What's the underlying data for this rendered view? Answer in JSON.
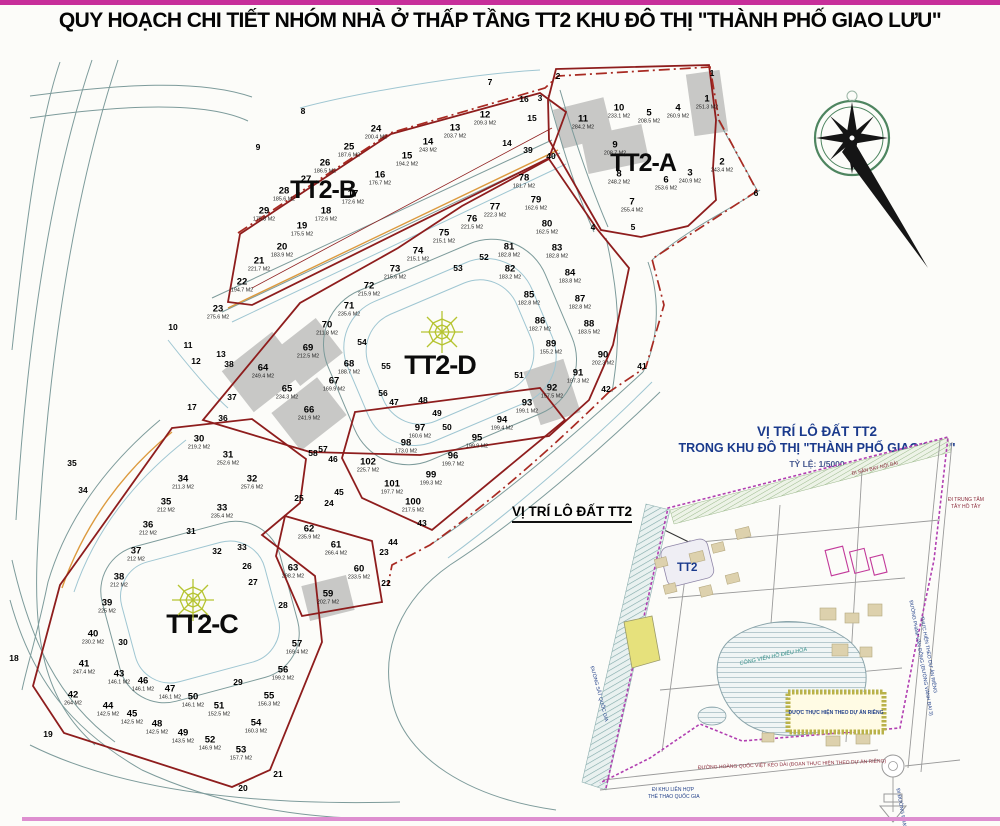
{
  "page": {
    "title": "QUY HOẠCH CHI TIẾT NHÓM NHÀ Ở THẤP TẦNG TT2 KHU ĐÔ THỊ \"THÀNH PHỐ GIAO LƯU\""
  },
  "map": {
    "blocks": [
      {
        "id": "tt2-a",
        "label": "TT2-A"
      },
      {
        "id": "tt2-b",
        "label": "TT2-B"
      },
      {
        "id": "tt2-c",
        "label": "TT2-C"
      },
      {
        "id": "tt2-d",
        "label": "TT2-D"
      }
    ],
    "parcels": [
      {
        "n": "1",
        "a": "251.3 M2",
        "x": 707,
        "y": 103,
        "g": 1,
        "r": -8,
        "w": 34,
        "h": 62
      },
      {
        "n": "2",
        "a": "243.4 M2",
        "x": 722,
        "y": 166
      },
      {
        "n": "3",
        "a": "240.9 M2",
        "x": 690,
        "y": 177
      },
      {
        "n": "4",
        "a": "260.9 M2",
        "x": 678,
        "y": 112
      },
      {
        "n": "5",
        "a": "208.5 M2",
        "x": 649,
        "y": 117
      },
      {
        "n": "6",
        "a": "253.6 M2",
        "x": 666,
        "y": 184
      },
      {
        "n": "7",
        "a": "255.4 M2",
        "x": 632,
        "y": 206
      },
      {
        "n": "8",
        "a": "248.2 M2",
        "x": 619,
        "y": 178
      },
      {
        "n": "9",
        "a": "208.7 M2",
        "x": 615,
        "y": 149,
        "g": 1,
        "r": -12,
        "w": 62,
        "h": 38
      },
      {
        "n": "10",
        "a": "233.1 M2",
        "x": 619,
        "y": 112
      },
      {
        "n": "11",
        "a": "284.2 M2",
        "x": 583,
        "y": 123,
        "g": 1,
        "r": -14,
        "w": 52,
        "h": 40
      },
      {
        "n": "12",
        "a": "209.3 M2",
        "x": 485,
        "y": 119
      },
      {
        "n": "13",
        "a": "203.7 M2",
        "x": 455,
        "y": 132
      },
      {
        "n": "14",
        "a": "243 M2",
        "x": 428,
        "y": 146
      },
      {
        "n": "15",
        "a": "194.2 M2",
        "x": 407,
        "y": 160
      },
      {
        "n": "16",
        "a": "176.7 M2",
        "x": 380,
        "y": 179
      },
      {
        "n": "17",
        "a": "172.6 M2",
        "x": 353,
        "y": 198
      },
      {
        "n": "18",
        "a": "172.6 M2",
        "x": 326,
        "y": 215
      },
      {
        "n": "19",
        "a": "175.5 M2",
        "x": 302,
        "y": 230
      },
      {
        "n": "20",
        "a": "183.9 M2",
        "x": 282,
        "y": 251
      },
      {
        "n": "21",
        "a": "221.7 M2",
        "x": 259,
        "y": 265
      },
      {
        "n": "22",
        "a": "194.7 M2",
        "x": 242,
        "y": 286
      },
      {
        "n": "23",
        "a": "275.6 M2",
        "x": 218,
        "y": 313
      },
      {
        "n": "24",
        "a": "200.4 M2",
        "x": 376,
        "y": 133
      },
      {
        "n": "25",
        "a": "187.6 M2",
        "x": 349,
        "y": 151
      },
      {
        "n": "26",
        "a": "186.5 M2",
        "x": 325,
        "y": 167
      },
      {
        "n": "27",
        "a": "",
        "x": 306,
        "y": 180
      },
      {
        "n": "28",
        "a": "185.6 M2",
        "x": 284,
        "y": 195
      },
      {
        "n": "29",
        "a": "175.8 M2",
        "x": 264,
        "y": 215
      },
      {
        "n": "30",
        "a": "219.2 M2",
        "x": 199,
        "y": 443
      },
      {
        "n": "31",
        "a": "252.6 M2",
        "x": 228,
        "y": 459
      },
      {
        "n": "32",
        "a": "257.6 M2",
        "x": 252,
        "y": 483
      },
      {
        "n": "33",
        "a": "235.4 M2",
        "x": 222,
        "y": 512
      },
      {
        "n": "34",
        "a": "211.3 M2",
        "x": 183,
        "y": 483
      },
      {
        "n": "35",
        "a": "212 M2",
        "x": 166,
        "y": 506
      },
      {
        "n": "36",
        "a": "212 M2",
        "x": 148,
        "y": 529
      },
      {
        "n": "37",
        "a": "212 M2",
        "x": 136,
        "y": 555
      },
      {
        "n": "38",
        "a": "212 M2",
        "x": 119,
        "y": 581
      },
      {
        "n": "39",
        "a": "225 M2",
        "x": 107,
        "y": 607
      },
      {
        "n": "40",
        "a": "230.2 M2",
        "x": 93,
        "y": 638
      },
      {
        "n": "41",
        "a": "247.4 M2",
        "x": 84,
        "y": 668
      },
      {
        "n": "42",
        "a": "264 M2",
        "x": 73,
        "y": 699
      },
      {
        "n": "43",
        "a": "146.1 M2",
        "x": 119,
        "y": 678
      },
      {
        "n": "44",
        "a": "142.5 M2",
        "x": 108,
        "y": 710
      },
      {
        "n": "45",
        "a": "142.5 M2",
        "x": 132,
        "y": 718
      },
      {
        "n": "46",
        "a": "146.1 M2",
        "x": 143,
        "y": 685
      },
      {
        "n": "47",
        "a": "146.1 M2",
        "x": 170,
        "y": 693
      },
      {
        "n": "48",
        "a": "142.5 M2",
        "x": 157,
        "y": 728
      },
      {
        "n": "49",
        "a": "143.5 M2",
        "x": 183,
        "y": 737
      },
      {
        "n": "50",
        "a": "146.1 M2",
        "x": 193,
        "y": 701
      },
      {
        "n": "51",
        "a": "152.5 M2",
        "x": 219,
        "y": 710
      },
      {
        "n": "52",
        "a": "146.9 M2",
        "x": 210,
        "y": 744
      },
      {
        "n": "53",
        "a": "157.7 M2",
        "x": 241,
        "y": 754
      },
      {
        "n": "54",
        "a": "160.3 M2",
        "x": 256,
        "y": 727
      },
      {
        "n": "55",
        "a": "156.3 M2",
        "x": 269,
        "y": 700
      },
      {
        "n": "56",
        "a": "199.2 M2",
        "x": 283,
        "y": 674
      },
      {
        "n": "57",
        "a": "169.4 M2",
        "x": 297,
        "y": 648
      },
      {
        "n": "59",
        "a": "202.7 M2",
        "x": 328,
        "y": 598,
        "g": 1,
        "r": -14,
        "w": 46,
        "h": 36
      },
      {
        "n": "60",
        "a": "233.5 M2",
        "x": 359,
        "y": 573
      },
      {
        "n": "61",
        "a": "266.4 M2",
        "x": 336,
        "y": 549
      },
      {
        "n": "62",
        "a": "235.9 M2",
        "x": 309,
        "y": 533
      },
      {
        "n": "63",
        "a": "298.2 M2",
        "x": 293,
        "y": 572
      },
      {
        "n": "64",
        "a": "249.4 M2",
        "x": 263,
        "y": 372,
        "g": 1,
        "r": -38,
        "w": 64,
        "h": 52
      },
      {
        "n": "65",
        "a": "234.3 M2",
        "x": 287,
        "y": 393
      },
      {
        "n": "66",
        "a": "241.9 M2",
        "x": 309,
        "y": 414,
        "g": 1,
        "r": -38,
        "w": 58,
        "h": 48
      },
      {
        "n": "67",
        "a": "169.9 M2",
        "x": 334,
        "y": 385
      },
      {
        "n": "68",
        "a": "188.7 M2",
        "x": 349,
        "y": 368
      },
      {
        "n": "69",
        "a": "212.5 M2",
        "x": 308,
        "y": 352,
        "g": 1,
        "r": -38,
        "w": 54,
        "h": 44
      },
      {
        "n": "70",
        "a": "211.8 M2",
        "x": 327,
        "y": 329
      },
      {
        "n": "71",
        "a": "235.6 M2",
        "x": 349,
        "y": 310
      },
      {
        "n": "72",
        "a": "215.9 M2",
        "x": 369,
        "y": 290
      },
      {
        "n": "73",
        "a": "215.6 M2",
        "x": 395,
        "y": 273
      },
      {
        "n": "74",
        "a": "215.1 M2",
        "x": 418,
        "y": 255
      },
      {
        "n": "75",
        "a": "215.1 M2",
        "x": 444,
        "y": 237
      },
      {
        "n": "76",
        "a": "221.5 M2",
        "x": 472,
        "y": 223
      },
      {
        "n": "77",
        "a": "222.3 M2",
        "x": 495,
        "y": 211
      },
      {
        "n": "78",
        "a": "181.7 M2",
        "x": 524,
        "y": 182
      },
      {
        "n": "79",
        "a": "162.6 M2",
        "x": 536,
        "y": 204
      },
      {
        "n": "80",
        "a": "162.5 M2",
        "x": 547,
        "y": 228
      },
      {
        "n": "81",
        "a": "182.8 M2",
        "x": 509,
        "y": 251
      },
      {
        "n": "82",
        "a": "183.2 M2",
        "x": 510,
        "y": 273
      },
      {
        "n": "83",
        "a": "182.8 M2",
        "x": 557,
        "y": 252
      },
      {
        "n": "84",
        "a": "183.8 M2",
        "x": 570,
        "y": 277
      },
      {
        "n": "85",
        "a": "182.8 M2",
        "x": 529,
        "y": 299
      },
      {
        "n": "86",
        "a": "182.7 M2",
        "x": 540,
        "y": 325
      },
      {
        "n": "87",
        "a": "182.8 M2",
        "x": 580,
        "y": 303
      },
      {
        "n": "88",
        "a": "183.5 M2",
        "x": 589,
        "y": 328
      },
      {
        "n": "89",
        "a": "155.2 M2",
        "x": 551,
        "y": 348
      },
      {
        "n": "90",
        "a": "202.3 M2",
        "x": 603,
        "y": 359
      },
      {
        "n": "91",
        "a": "197.3 M2",
        "x": 578,
        "y": 377
      },
      {
        "n": "92",
        "a": "157.5 M2",
        "x": 552,
        "y": 392,
        "g": 1,
        "r": -18,
        "w": 42,
        "h": 56
      },
      {
        "n": "93",
        "a": "199.1 M2",
        "x": 527,
        "y": 407
      },
      {
        "n": "94",
        "a": "199.4 M2",
        "x": 502,
        "y": 424
      },
      {
        "n": "95",
        "a": "199.9 M2",
        "x": 477,
        "y": 442
      },
      {
        "n": "96",
        "a": "199.7 M2",
        "x": 453,
        "y": 460
      },
      {
        "n": "97",
        "a": "160.6 M2",
        "x": 420,
        "y": 432
      },
      {
        "n": "98",
        "a": "173.0 M2",
        "x": 406,
        "y": 447
      },
      {
        "n": "99",
        "a": "199.3 M2",
        "x": 431,
        "y": 479
      },
      {
        "n": "100",
        "a": "217.5 M2",
        "x": 413,
        "y": 506
      },
      {
        "n": "101",
        "a": "197.7 M2",
        "x": 392,
        "y": 488
      },
      {
        "n": "102",
        "a": "225.7 M2",
        "x": 368,
        "y": 466
      }
    ],
    "markers": [
      {
        "n": "1",
        "x": 712,
        "y": 73
      },
      {
        "n": "2",
        "x": 558,
        "y": 76
      },
      {
        "n": "3",
        "x": 540,
        "y": 98
      },
      {
        "n": "4",
        "x": 593,
        "y": 227
      },
      {
        "n": "5",
        "x": 633,
        "y": 227
      },
      {
        "n": "6",
        "x": 756,
        "y": 193
      },
      {
        "n": "7",
        "x": 490,
        "y": 82
      },
      {
        "n": "8",
        "x": 303,
        "y": 111
      },
      {
        "n": "9",
        "x": 258,
        "y": 147
      },
      {
        "n": "10",
        "x": 173,
        "y": 327
      },
      {
        "n": "11",
        "x": 188,
        "y": 345
      },
      {
        "n": "12",
        "x": 196,
        "y": 361
      },
      {
        "n": "13",
        "x": 221,
        "y": 354
      },
      {
        "n": "14",
        "x": 507,
        "y": 143
      },
      {
        "n": "15",
        "x": 532,
        "y": 118
      },
      {
        "n": "16",
        "x": 524,
        "y": 99
      },
      {
        "n": "17",
        "x": 192,
        "y": 407
      },
      {
        "n": "18",
        "x": 14,
        "y": 658
      },
      {
        "n": "19",
        "x": 48,
        "y": 734
      },
      {
        "n": "20",
        "x": 243,
        "y": 788
      },
      {
        "n": "21",
        "x": 278,
        "y": 774
      },
      {
        "n": "22",
        "x": 386,
        "y": 583
      },
      {
        "n": "23",
        "x": 384,
        "y": 552
      },
      {
        "n": "24",
        "x": 329,
        "y": 503
      },
      {
        "n": "25",
        "x": 299,
        "y": 498
      },
      {
        "n": "26",
        "x": 247,
        "y": 566
      },
      {
        "n": "27",
        "x": 253,
        "y": 582
      },
      {
        "n": "28",
        "x": 283,
        "y": 605
      },
      {
        "n": "29",
        "x": 238,
        "y": 682
      },
      {
        "n": "30",
        "x": 123,
        "y": 642
      },
      {
        "n": "31",
        "x": 191,
        "y": 531
      },
      {
        "n": "32",
        "x": 217,
        "y": 551
      },
      {
        "n": "33",
        "x": 242,
        "y": 547
      },
      {
        "n": "34",
        "x": 83,
        "y": 490
      },
      {
        "n": "35",
        "x": 72,
        "y": 463
      },
      {
        "n": "36",
        "x": 223,
        "y": 418
      },
      {
        "n": "37",
        "x": 232,
        "y": 397
      },
      {
        "n": "38",
        "x": 229,
        "y": 364
      },
      {
        "n": "39",
        "x": 528,
        "y": 150
      },
      {
        "n": "40",
        "x": 551,
        "y": 156
      },
      {
        "n": "41",
        "x": 642,
        "y": 366
      },
      {
        "n": "42",
        "x": 606,
        "y": 389
      },
      {
        "n": "43",
        "x": 422,
        "y": 523
      },
      {
        "n": "44",
        "x": 393,
        "y": 542
      },
      {
        "n": "45",
        "x": 339,
        "y": 492
      },
      {
        "n": "46",
        "x": 333,
        "y": 459
      },
      {
        "n": "47",
        "x": 394,
        "y": 402
      },
      {
        "n": "48",
        "x": 423,
        "y": 400
      },
      {
        "n": "49",
        "x": 437,
        "y": 413
      },
      {
        "n": "50",
        "x": 447,
        "y": 427
      },
      {
        "n": "51",
        "x": 519,
        "y": 375
      },
      {
        "n": "52",
        "x": 484,
        "y": 257
      },
      {
        "n": "53",
        "x": 458,
        "y": 268
      },
      {
        "n": "54",
        "x": 362,
        "y": 342
      },
      {
        "n": "55",
        "x": 386,
        "y": 366
      },
      {
        "n": "56",
        "x": 383,
        "y": 393
      },
      {
        "n": "57",
        "x": 323,
        "y": 449
      },
      {
        "n": "58",
        "x": 313,
        "y": 453
      }
    ]
  },
  "location_map": {
    "title1": "VỊ TRÍ LÔ ĐẤT TT2",
    "title2": "TRONG KHU ĐÔ THỊ \"THÀNH PHỐ GIAO LƯU\"",
    "scale": "TỶ LỆ: 1/5000",
    "callout": "VỊ TRÍ LÔ ĐẤT TT2",
    "tt2_label": "TT2",
    "project_box": "ĐƯỢC THỰC HIỆN THEO DỰ ÁN RIÊNG",
    "labels": [
      {
        "t": "ĐI SÂN BAY NỘI BÀI",
        "x": 852,
        "y": 472,
        "r": -13,
        "c": "red"
      },
      {
        "t": "ĐI TRUNG TÂM",
        "x": 948,
        "y": 498,
        "r": 0,
        "c": "red"
      },
      {
        "t": "TÂY HỒ TÂY",
        "x": 951,
        "y": 505,
        "r": 0,
        "c": "red"
      },
      {
        "t": "ĐI KHU LIÊN HỢP",
        "x": 652,
        "y": 788,
        "r": 0,
        "c": "navy"
      },
      {
        "t": "THỂ THAO QUỐC GIA",
        "x": 648,
        "y": 795,
        "r": 0,
        "c": "navy"
      },
      {
        "t": "ĐƯỜNG HOÀNG QUỐC VIỆT KÉO DÀI (ĐOẠN THỰC HIỆN THEO DỰ ÁN RIÊNG)",
        "x": 698,
        "y": 766,
        "r": -2,
        "c": "red"
      },
      {
        "t": "ĐƯỜNG PHẠM VĂN ĐỒNG (ĐƯỜNG VÀNH ĐAI 3)",
        "x": 910,
        "y": 598,
        "r": 80,
        "c": "navy"
      },
      {
        "t": "THỰC HIỆN THEO DỰ ÁN RIÊNG",
        "x": 921,
        "y": 614,
        "r": 80,
        "c": "navy"
      },
      {
        "t": "ĐI ĐƯỜNG PHẠM HÙNG",
        "x": 897,
        "y": 786,
        "r": 80,
        "c": "navy"
      },
      {
        "t": "CÔNG VIÊN HỒ ĐIỀU HÒA",
        "x": 740,
        "y": 662,
        "r": -12,
        "c": "teal"
      },
      {
        "t": "ĐƯỜNG SẮT QUỐC GIA",
        "x": 591,
        "y": 664,
        "r": 75,
        "c": "navy"
      }
    ]
  },
  "colors": {
    "frame_magenta": "#c72f9a",
    "block_outline_red": "#8e1d1d",
    "boundary_dashdot_red": "#a82a22",
    "road_gray": "#7d9b9b",
    "road_cyan": "#9fc6d2",
    "utility_orange": "#dc9a3e",
    "gray_lot": "#c8c8c6",
    "web_icon_green": "#b6c431",
    "compass_green": "#4e8560",
    "navy_text": "#1a3a8c",
    "purple_boundary": "#b13fb1"
  }
}
